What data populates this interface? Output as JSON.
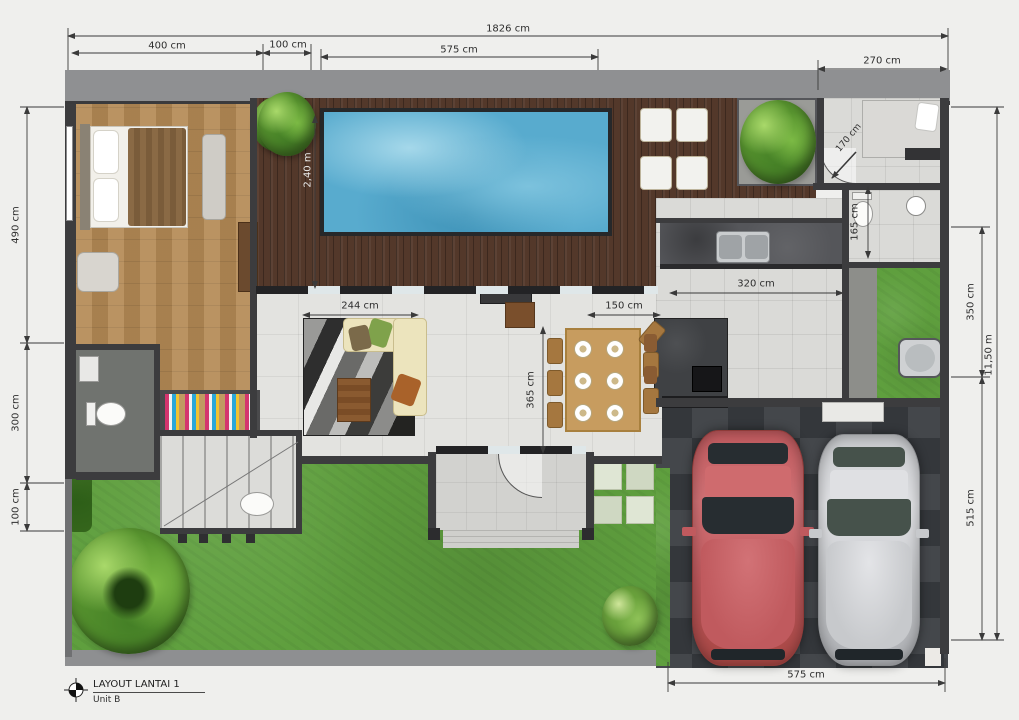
{
  "title_block": {
    "title": "LAYOUT LANTAI 1",
    "unit": "Unit B"
  },
  "dimensions": {
    "top_total": "1826 cm",
    "top_seg_400": "400 cm",
    "top_seg_100": "100 cm",
    "top_seg_575": "575 cm",
    "top_seg_270": "270 cm",
    "left_490": "490 cm",
    "left_300": "300 cm",
    "left_100": "100 cm",
    "right_350": "350 cm",
    "right_total_m": "11,50 m",
    "right_515": "515 cm",
    "pool_240m": "2,40 m",
    "living_244": "244 cm",
    "hall_150": "150 cm",
    "kitchen_320": "320 cm",
    "dining_365": "365 cm",
    "service_165": "165 cm",
    "maid_170": "170 cm",
    "garage_575": "575 cm"
  },
  "icons": {
    "compass": "north-compass-icon"
  },
  "colors": {
    "pool_water": "#58abce",
    "deck_wood": "#53382a",
    "bedroom_wood": "#b48a55",
    "grass": "#5f9f3e",
    "garage_floor": "#3b3d40",
    "car_red": "#c05a5e",
    "car_silver": "#c7c9cc",
    "wall": "#3c3c3e",
    "dimension_text": "#2e2e2e"
  }
}
